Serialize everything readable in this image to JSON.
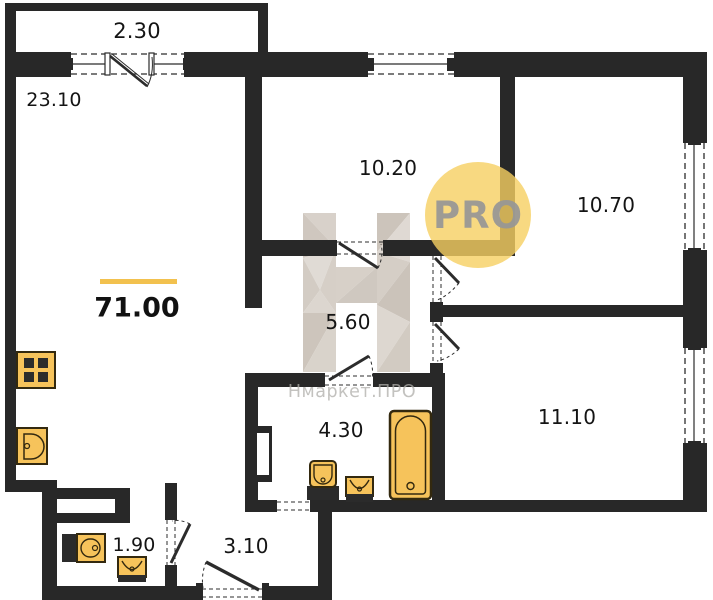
{
  "plan": {
    "title": "apartment floor plan",
    "total_area": "71.00",
    "badge_label": "PRO",
    "watermark": {
      "logo_letter": "H",
      "text": "Нмаркет.ПРО"
    },
    "rooms": [
      {
        "id": "balcony",
        "area": "2.30"
      },
      {
        "id": "living-room",
        "area": "23.10"
      },
      {
        "id": "bedroom-1",
        "area": "10.20"
      },
      {
        "id": "bedroom-2",
        "area": "10.70"
      },
      {
        "id": "hallway",
        "area": "5.60"
      },
      {
        "id": "bedroom-3",
        "area": "11.10"
      },
      {
        "id": "bathroom",
        "area": "4.30"
      },
      {
        "id": "wc",
        "area": "1.90"
      },
      {
        "id": "entry-hall",
        "area": "3.10"
      }
    ],
    "fixtures": [
      "stove-icon",
      "kitchen-sink-icon",
      "toilet-icon",
      "sink-icon",
      "bathtub-icon",
      "washbasin-icon",
      "sink-icon"
    ],
    "colors": {
      "wall": "#282828",
      "fixture_fill": "#F6C35B",
      "fixture_stroke": "#33290f",
      "accent_line": "#F2C14E",
      "badge_fill": "#F6D062",
      "badge_text": "#969696",
      "watermark": "#d5cec7"
    }
  }
}
